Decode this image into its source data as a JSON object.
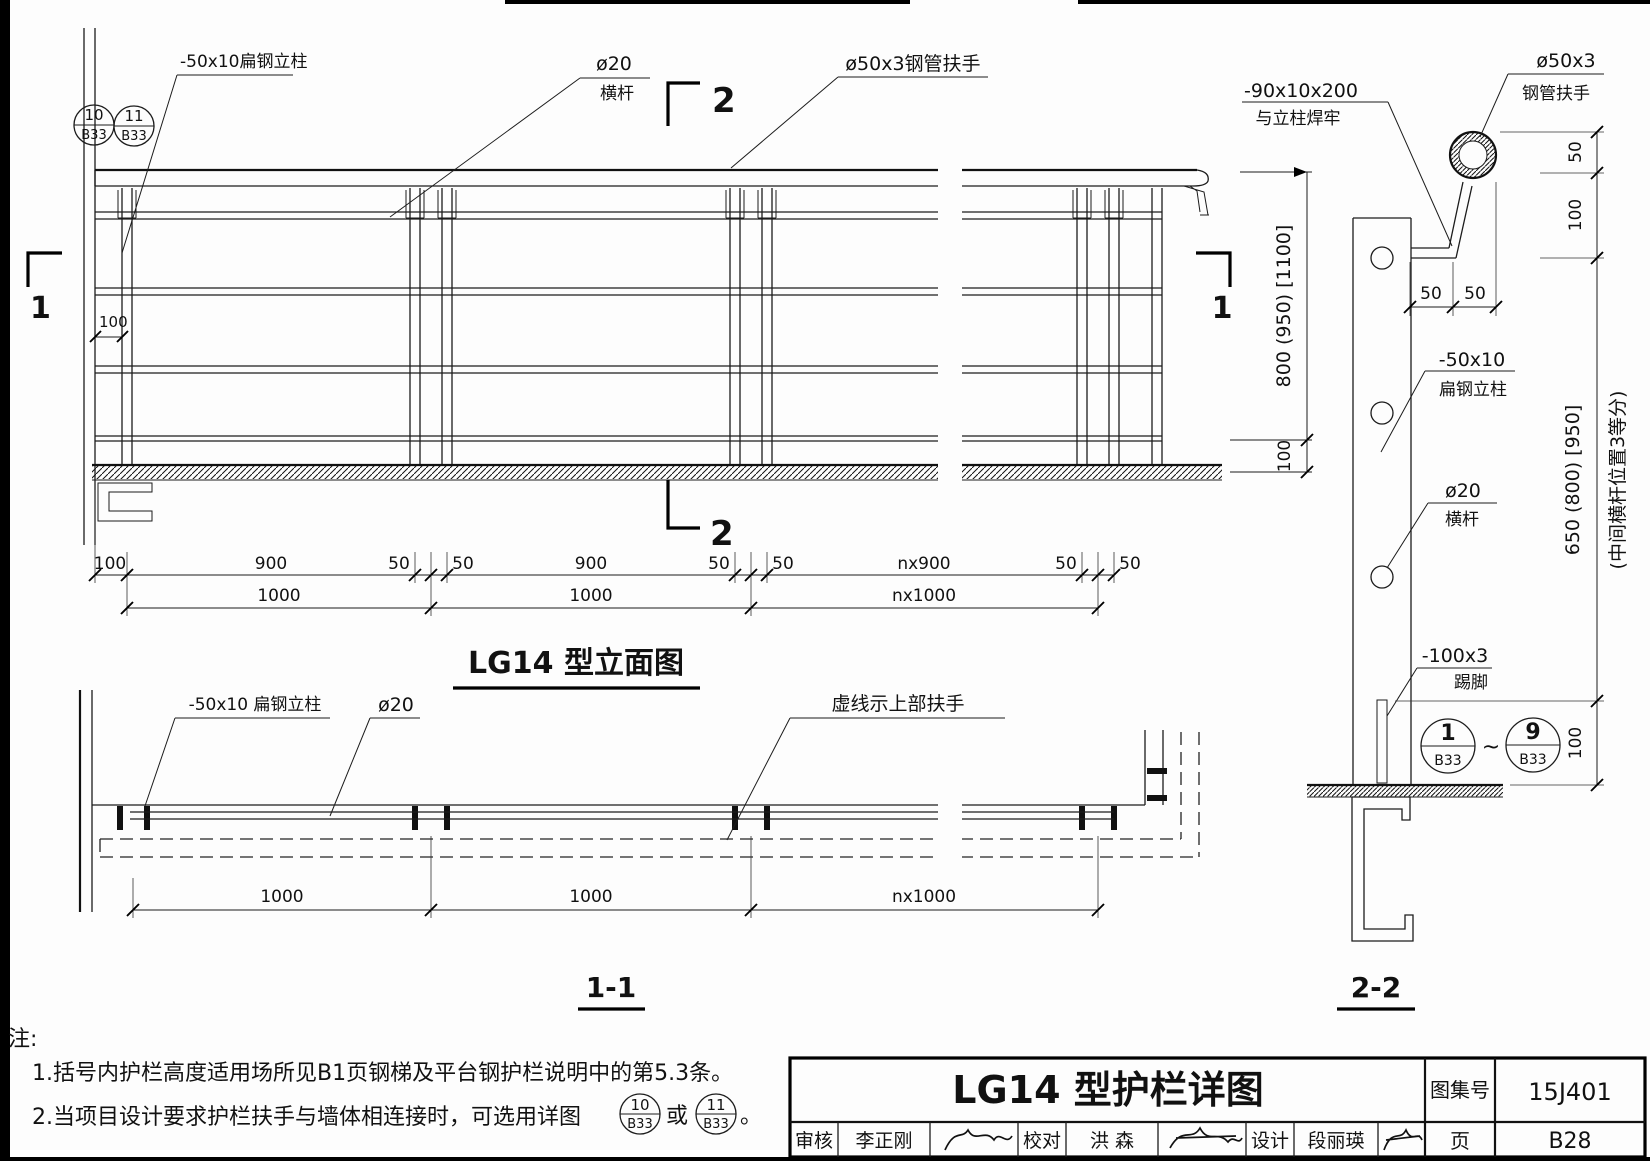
{
  "elevation": {
    "title": "LG14 型立面图",
    "label_post": "-50x10扁钢立柱",
    "label_rod_dia": "ø20",
    "label_rod_name": "横杆",
    "label_handrail": "ø50x3钢管扶手",
    "detail_circle_1": {
      "num": "10",
      "sheet": "B33"
    },
    "detail_circle_2": {
      "num": "11",
      "sheet": "B33"
    },
    "dim_wall_offset": "100",
    "dims_row1": [
      "100",
      "900",
      "50",
      "50",
      "900",
      "50",
      "50",
      "nx900",
      "50",
      "50"
    ],
    "dims_row2": [
      "1000",
      "1000",
      "nx1000"
    ],
    "dim_height": "800 (950) [1100]",
    "dim_kick": "100",
    "mark_left": "1",
    "mark_right": "1",
    "mark_top": "2",
    "mark_bottom": "2"
  },
  "plan": {
    "title": "1-1",
    "label_post": "-50x10 扁钢立柱",
    "label_rod": "ø20",
    "label_dashed": "虚线示上部扶手",
    "dims": [
      "1000",
      "1000",
      "nx1000"
    ]
  },
  "section": {
    "title": "2-2",
    "label_handrail_1": "ø50x3",
    "label_handrail_2": "钢管扶手",
    "label_bracket_1": "-90x10x200",
    "label_bracket_2": "与立柱焊牢",
    "label_post_1": "-50x10",
    "label_post_2": "扁钢立柱",
    "label_rod_1": "ø20",
    "label_rod_2": "横杆",
    "label_kick_1": "-100x3",
    "label_kick_2": "踢脚",
    "dim_top": [
      "50",
      "50"
    ],
    "dims_right": [
      "50",
      "100",
      "650 (800) [950]",
      "100"
    ],
    "dim_note": "(中间横杆位置3等分)",
    "detail_circle_start": {
      "num": "1",
      "sheet": "B33"
    },
    "detail_circle_end": {
      "num": "9",
      "sheet": "B33"
    },
    "tilde": "~"
  },
  "notes": {
    "header": "注:",
    "line1": "1.括号内护栏高度适用场所见B1页钢梯及平台钢护栏说明中的第5.3条。",
    "line2_prefix": "2.当项目设计要求护栏扶手与墙体相连接时，可选用详图",
    "line2_or": "或",
    "line2_end": "。",
    "circle_a": {
      "num": "10",
      "sheet": "B33"
    },
    "circle_b": {
      "num": "11",
      "sheet": "B33"
    }
  },
  "titleblock": {
    "title": "LG14 型护栏详图",
    "atlas_label": "图集号",
    "atlas_no": "15J401",
    "page_label": "页",
    "page_no": "B28",
    "review_label": "审核",
    "review_name": "李正刚",
    "check_label": "校对",
    "check_name": "洪  森",
    "design_label": "设计",
    "design_name": "段丽瑛"
  }
}
